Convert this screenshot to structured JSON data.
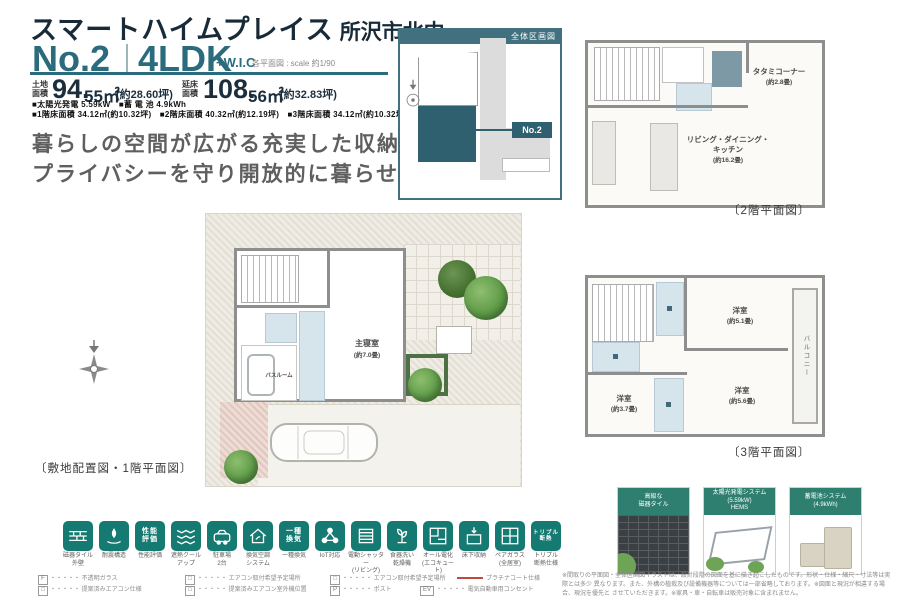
{
  "header": {
    "brand": "スマートハイムプレイス",
    "location": "所沢市北中",
    "plan_no": "No.2",
    "layout": "4LDK",
    "layout_suffix": "+W.I.C",
    "scale_note": "各平面図 : scale 約1/90",
    "land_label": "土地面積",
    "land_int": "94.",
    "land_dec": "55㎡",
    "land_tsubo": "(約28.60坪)",
    "building_label": "延床面積",
    "building_int": "108.",
    "building_dec": "56㎡",
    "building_tsubo": "(約32.83坪)",
    "spec_line1": "■太陽光発電 5.59kW　■蓄 電 池 4.9kWh",
    "spec_line2": "■1階床面積 34.12㎡(約10.32坪)　■2階床面積 40.32㎡(約12.19坪)　■3階床面積 34.12㎡(約10.32坪)",
    "catch1": "暮らしの空間が広がる充実した収納と",
    "catch2": "プライバシーを守り開放的に暮らせる家。"
  },
  "sitemap": {
    "title": "全体区画図",
    "plot_label": "No.2"
  },
  "plan2f": {
    "tatami": "タタミコーナー",
    "tatami_size": "(約2.8畳)",
    "ldk1": "リビング・ダイニング・",
    "ldk2": "キッチン",
    "ldk_size": "(約16.2畳)",
    "caption": "〔2階平面図〕"
  },
  "plan3f": {
    "room1": "洋室",
    "room1_size": "(約5.1畳)",
    "room2": "洋室",
    "room2_size": "(約3.7畳)",
    "room3": "洋室",
    "room3_size": "(約5.6畳)",
    "balcony": "バルコニー",
    "caption": "〔3階平面図〕"
  },
  "plan1f": {
    "bedroom": "主寝室",
    "bedroom_size": "(約7.0畳)",
    "bath": "バスルーム",
    "caption": "〔敷地配置図・1階平面図〕"
  },
  "features": {
    "items": [
      {
        "l1": "磁器タイル",
        "l2": "外壁",
        "g1": "",
        "g2": ""
      },
      {
        "l1": "耐震構造",
        "l2": "",
        "g1": "",
        "g2": ""
      },
      {
        "l1": "性能評価",
        "l2": "",
        "g1": "性能",
        "g2": "評価"
      },
      {
        "l1": "遮熱クール",
        "l2": "アップ",
        "g1": "",
        "g2": ""
      },
      {
        "l1": "駐車場",
        "l2": "2台",
        "g1": "",
        "g2": ""
      },
      {
        "l1": "換気空調",
        "l2": "システム",
        "g1": "",
        "g2": ""
      },
      {
        "l1": "一種換気",
        "l2": "",
        "g1": "一種",
        "g2": "換気"
      },
      {
        "l1": "IoT対応",
        "l2": "",
        "g1": "",
        "g2": ""
      },
      {
        "l1": "電動シャッター",
        "l2": "(リビング)",
        "g1": "",
        "g2": ""
      },
      {
        "l1": "食器洗い",
        "l2": "乾燥機",
        "g1": "",
        "g2": ""
      },
      {
        "l1": "オール電化",
        "l2": "(エコキュート)",
        "g1": "",
        "g2": ""
      },
      {
        "l1": "床下収納",
        "l2": "",
        "g1": "",
        "g2": ""
      },
      {
        "l1": "ペアガラス",
        "l2": "(全居室)",
        "g1": "",
        "g2": ""
      },
      {
        "l1": "トリプル",
        "l2": "断熱仕様",
        "g1": "トリプル",
        "g2": "断熱"
      }
    ]
  },
  "highlights": {
    "boxes": [
      {
        "t1": "高級な",
        "t2": "磁器タイル",
        "t3": ""
      },
      {
        "t1": "太陽光発電システム",
        "t2": "(5.59kW)",
        "t3": "HEMS"
      },
      {
        "t1": "蓄電池システム",
        "t2": "(4.9kWh)",
        "t3": ""
      }
    ]
  },
  "legend": {
    "row1": [
      {
        "sym": "F",
        "text": "・・・・・ 不透明ガラス"
      },
      {
        "sym": "□",
        "text": "・・・・・ エアコン取付希望予定場所"
      },
      {
        "sym": "□",
        "text": "・・・・・ エアコン取付希望予定場所"
      },
      {
        "sym": "",
        "text": "プラチナコート仕様"
      }
    ],
    "row2": [
      {
        "sym": "□",
        "text": "・・・・・ 提案済みエアコン仕様"
      },
      {
        "sym": "□",
        "text": "・・・・・ 提案済みエアコン室外機位置"
      },
      {
        "sym": "P",
        "text": "・・・・・ ポスト"
      },
      {
        "sym": "EV",
        "text": "・・・・・ 電気自動車用コンセント"
      }
    ]
  },
  "disclaimer": {
    "l1": "※間取りの平面図・全体区画図イラストは、設計段階の図面を基に描き起こしたものです。形状・仕様・縮尺・寸法等は実際とは多少",
    "l2": "異なります。また、外構の植栽及び設備機器等については一部省略しております。※図面と現況が相違する場合、現況を優先と",
    "l3": "させていただきます。※家具・車・自転車は販売対象に含まれません。"
  },
  "colors": {
    "accent": "#2b6b7e",
    "icon_teal": "#157a72",
    "plot_fill": "#2f6070",
    "header_teal": "#2e7f70"
  }
}
